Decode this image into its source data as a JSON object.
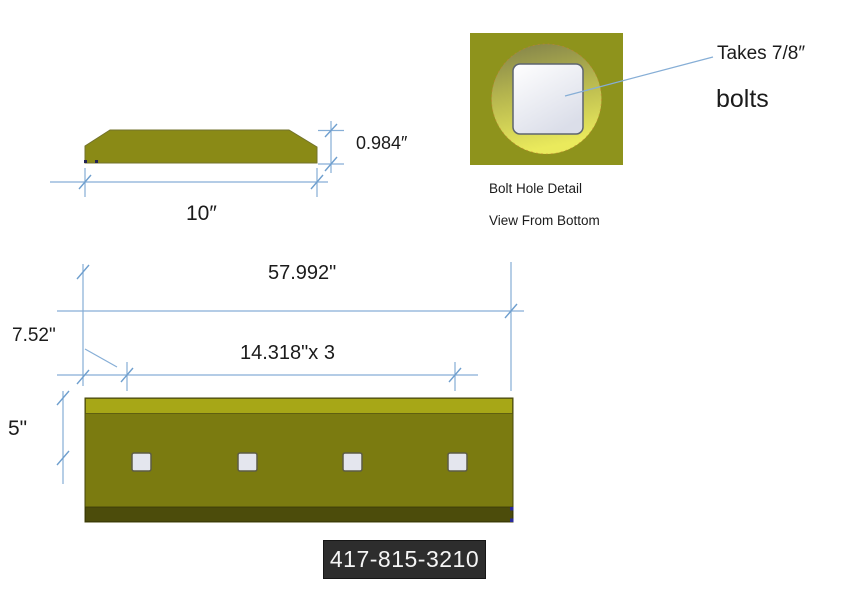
{
  "page": {
    "background": "#ffffff"
  },
  "colors": {
    "dim_line": "#86aed6",
    "tick": "#6f9fce",
    "profile_fill": "#8a8a16",
    "blade_top_strip": "#a7a717",
    "blade_body": "#7b7b10",
    "blade_bottom_strip": "#4c4c0b",
    "detail_square": "#8e931c",
    "hole_fill": "#e4e6ee",
    "hole_border": "#5c5c45",
    "phone_bg": "#2d2d2d",
    "phone_fg": "#f5f5f5",
    "text": "#1b1b1b",
    "endpoint_dot": "#2a2a99"
  },
  "profile_view": {
    "thickness_label": "0.984″",
    "width_label": "10″"
  },
  "bolt_hole_detail": {
    "note_line1": "Takes 7/8″",
    "note_line2": "bolts",
    "caption_line1": "Bolt Hole Detail",
    "caption_line2": "View From Bottom"
  },
  "bottom_view": {
    "overall_length_label": "57.992\"",
    "end_offset_label": "7.52\"",
    "hole_spacing_label": "14.318\"x 3",
    "hole_center_label": "5\"",
    "hole_count": 4
  },
  "phone": {
    "number": "417-815-3210"
  }
}
